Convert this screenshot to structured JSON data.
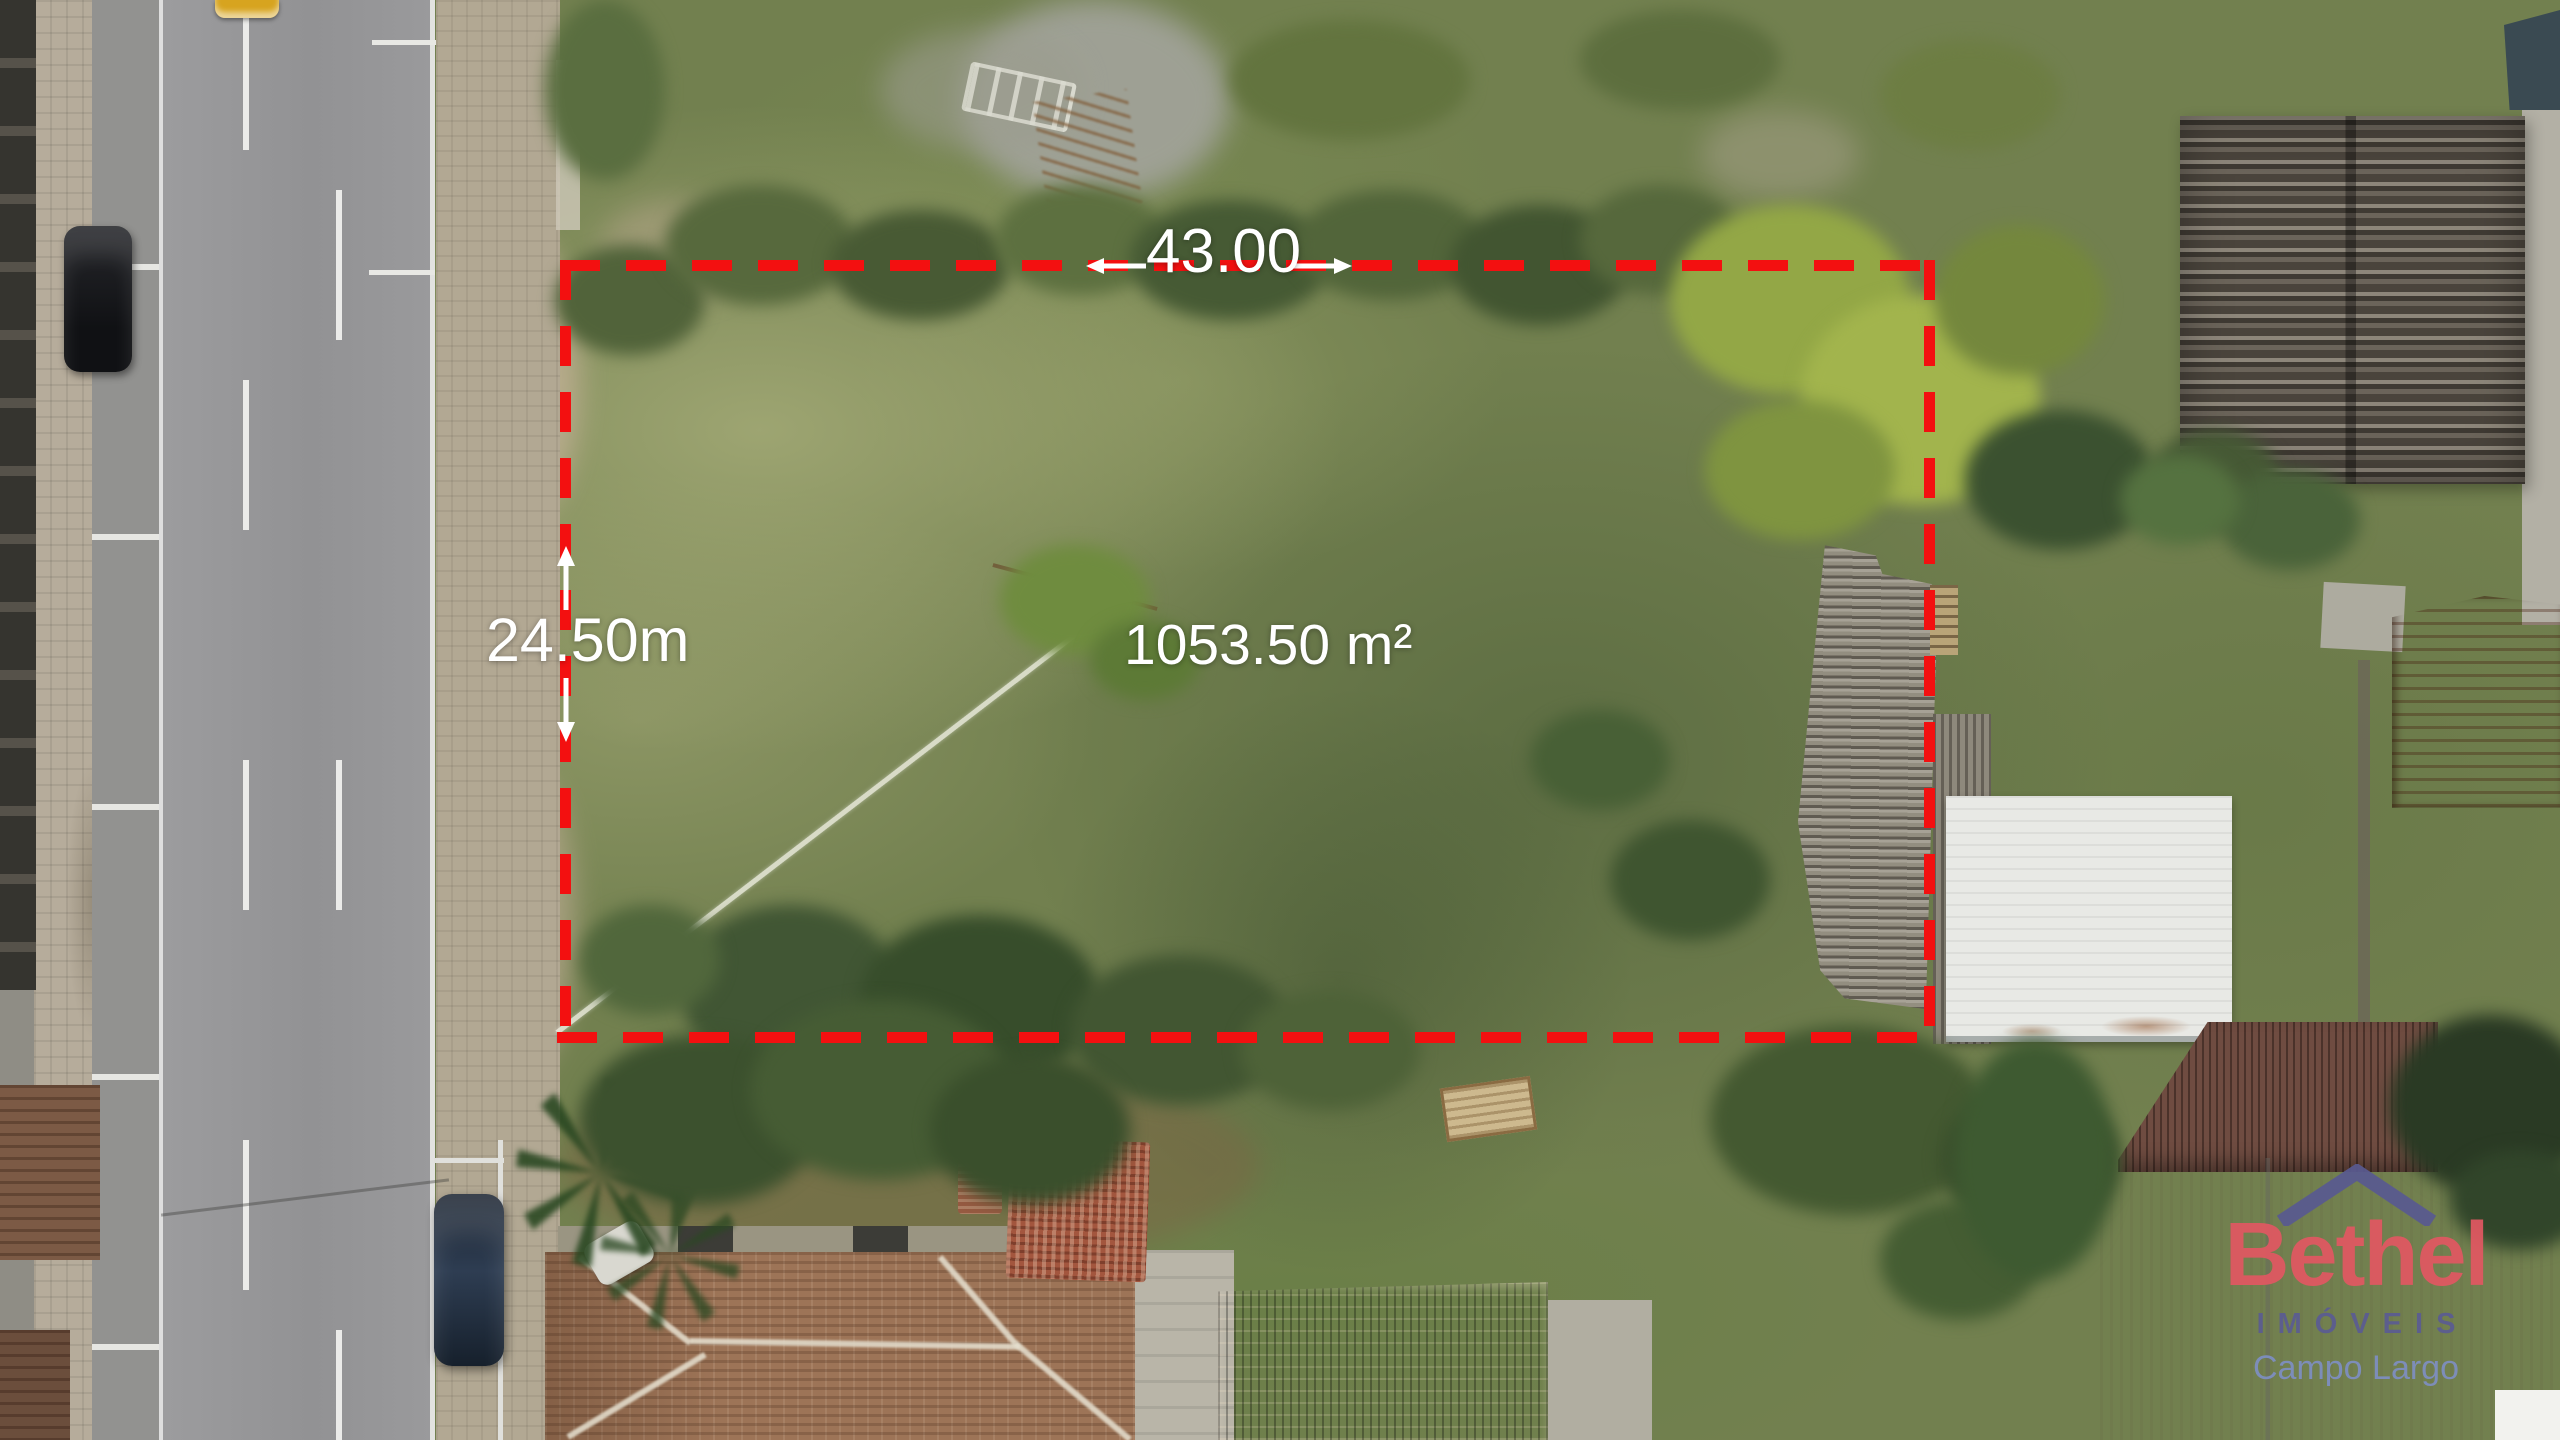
{
  "scene": {
    "type": "aerial-drone-photo-land-plot",
    "boundary_color": "#f31010",
    "annotation_text_color": "#ffffff"
  },
  "annotations": {
    "width_label": "43.00",
    "depth_label": "24.50m",
    "area_label": "1053.50 m²"
  },
  "watermark": {
    "brand": "Bethel",
    "subtitle": "IMÓVEIS",
    "location": "Campo Largo",
    "brand_color": "#e15862",
    "subtitle_color": "#5b5c92",
    "location_color": "#7e8fc2",
    "roof_icon_color": "#595a90"
  }
}
